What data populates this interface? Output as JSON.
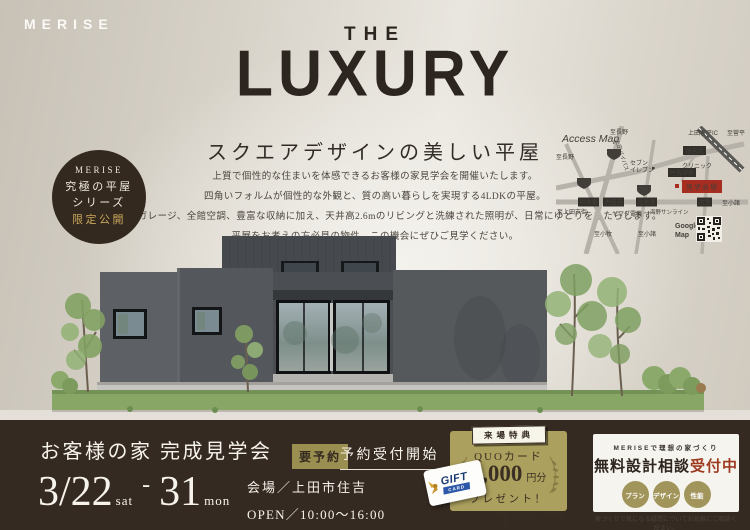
{
  "logo": "MERISE",
  "hero": {
    "line_the": "THE",
    "line_luxury": "LUXURY",
    "subtitle": "スクエアデザインの美しい平屋",
    "body": [
      "上質で個性的な住まいを体感できるお客様の家見学会を開催いたします。",
      "四角いフォルムが個性的な外観と、質の高い暮らしを実現する4LDKの平屋。",
      "ビルトインガレージ、全館空調、豊富な収納に加え、天井高2.6mのリビングと洗練された照明が、日常にゆとりをもたらします。",
      "平屋をお考えの方必見の物件。この機会にぜひご見学ください。"
    ]
  },
  "series_badge": {
    "line1": "MERISE",
    "line2": "究極の平屋",
    "line3": "シリーズ",
    "line4": "限定公開"
  },
  "map": {
    "title": "Access Map",
    "venue": "見学会場",
    "google1": "Google",
    "google2": "Map",
    "junction_boxes": [
      "住吉北",
      "住吉中央",
      "中央東",
      "吉田西",
      "住吉東",
      "古里"
    ],
    "road_labels": [
      "至長野",
      "至長野",
      "上田菅平IC",
      "至菅平",
      "上田バイパス",
      "セブン",
      "イレブン",
      "クリニック",
      "海野サンライン",
      "至小諸",
      "ヤマダ電機",
      "至上田市街",
      "至小牧",
      "至小諸"
    ],
    "route_shields": [
      "144",
      "18",
      "18"
    ]
  },
  "event": {
    "title": "お客様の家 完成見学会",
    "badge": "要予約",
    "status": "予約受付開始",
    "date_start": "3/22",
    "date_start_suffix": "sat",
    "dash": "-",
    "date_end": "31",
    "date_end_suffix": "mon",
    "venue": "会場／上田市住吉",
    "open": "OPEN／10:00～16:00"
  },
  "gift": {
    "badge": "来場特典",
    "line1": "QUOカード",
    "amount": "3,000",
    "amount_unit": "円分",
    "line2": "プレゼント！",
    "note": "アンケートにご回答いただいたご家族限定！",
    "card_title": "GIFT",
    "card_sub": "CARD"
  },
  "consult": {
    "heading": "MERISEで理想の家づくり",
    "title": "無料設計相談",
    "title_accent": "受付中",
    "chips": [
      "プラン",
      "デザイン",
      "性能"
    ],
    "note": "家づくりで気になる疑問についてお気軽にご相談ください。"
  },
  "colors": {
    "bar_brown": "#352a21",
    "accent_gold": "#aca05e",
    "badge_gold": "#9a8f51",
    "highlight_gold": "#c9a85c",
    "venue_red": "#a72d20",
    "accent_red": "#9d3a20",
    "wall_gray": "#55595c",
    "grass_green": "#88a766"
  }
}
